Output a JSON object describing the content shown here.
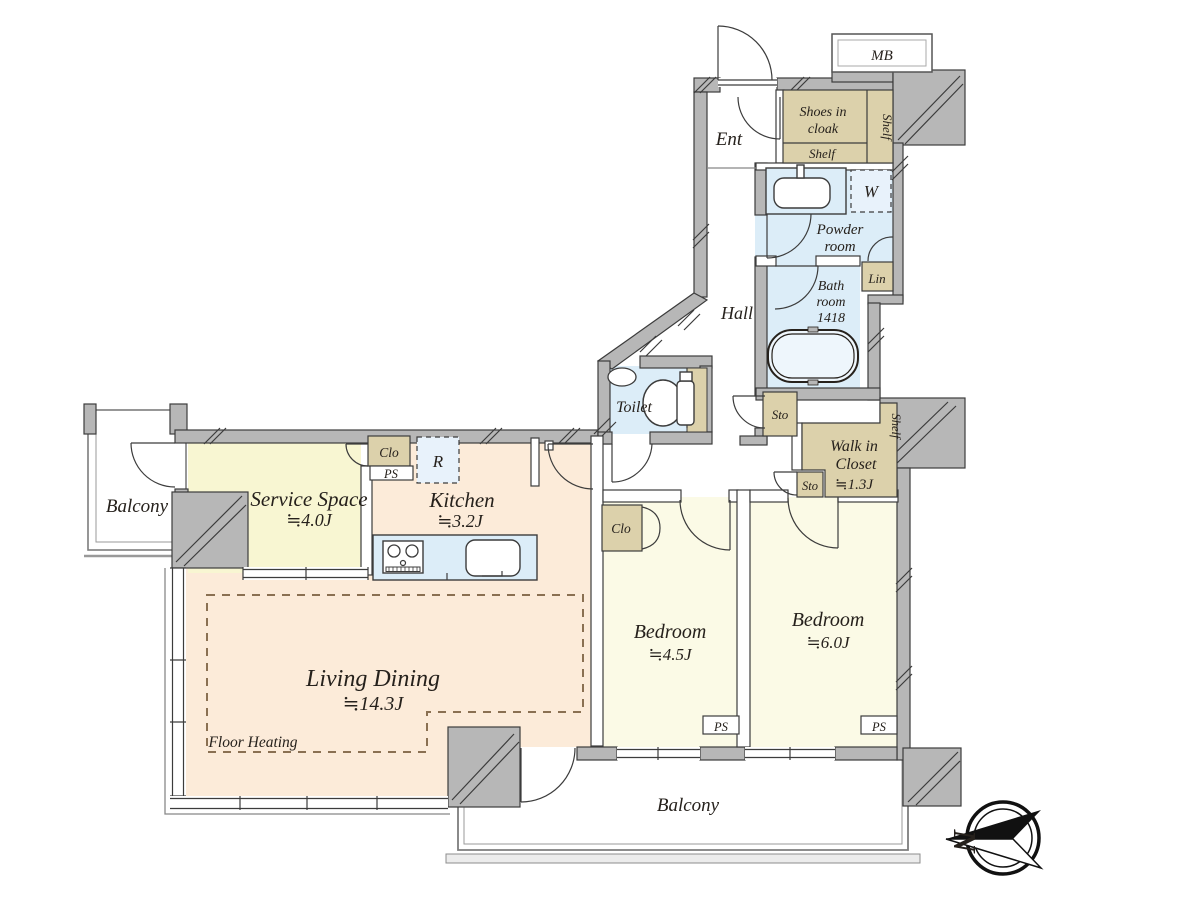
{
  "colors": {
    "wall_gray": "#b7b7b7",
    "wall_edge": "#3c3c3c",
    "living_peach": "#fcebd9",
    "bedroom_yellow": "#fbfae6",
    "service_yellow": "#f8f6d2",
    "wet_blue": "#dcedf8",
    "storage_tan": "#dcd1ab",
    "floor_heating_dash": "#8a7052"
  },
  "compass": {
    "north_label": "N"
  },
  "rooms": {
    "mb": "MB",
    "ent": "Ent",
    "shoes_cloak_line1": "Shoes in",
    "shoes_cloak_line2": "cloak",
    "shelf_cloak_bottom": "Shelf",
    "shelf_cloak_side": "Shelf",
    "washer": "W",
    "powder_line1": "Powder",
    "powder_line2": "room",
    "lin": "Lin",
    "bath_line1": "Bath",
    "bath_line2": "room",
    "bath_line3": "1418",
    "hall": "Hall",
    "toilet": "Toilet",
    "sto_upper": "Sto",
    "sto_lower": "Sto",
    "wic_line1": "Walk in",
    "wic_line2": "Closet",
    "wic_size": "≒1.3J",
    "shelf_wic": "Shelf",
    "clo_kitchen": "Clo",
    "ps_kitchen": "PS",
    "fridge": "R",
    "kitchen_name": "Kitchen",
    "kitchen_size": "≒3.2J",
    "service_name": "Service Space",
    "service_size": "≒4.0J",
    "balcony_left": "Balcony",
    "living_name": "Living Dining",
    "living_size": "≒14.3J",
    "floor_heating": "Floor Heating",
    "bedroom_a_name": "Bedroom",
    "bedroom_a_size": "≒4.5J",
    "clo_bedroom": "Clo",
    "bedroom_b_name": "Bedroom",
    "bedroom_b_size": "≒6.0J",
    "ps_bedroom_a": "PS",
    "ps_bedroom_b": "PS",
    "balcony_bottom": "Balcony"
  }
}
